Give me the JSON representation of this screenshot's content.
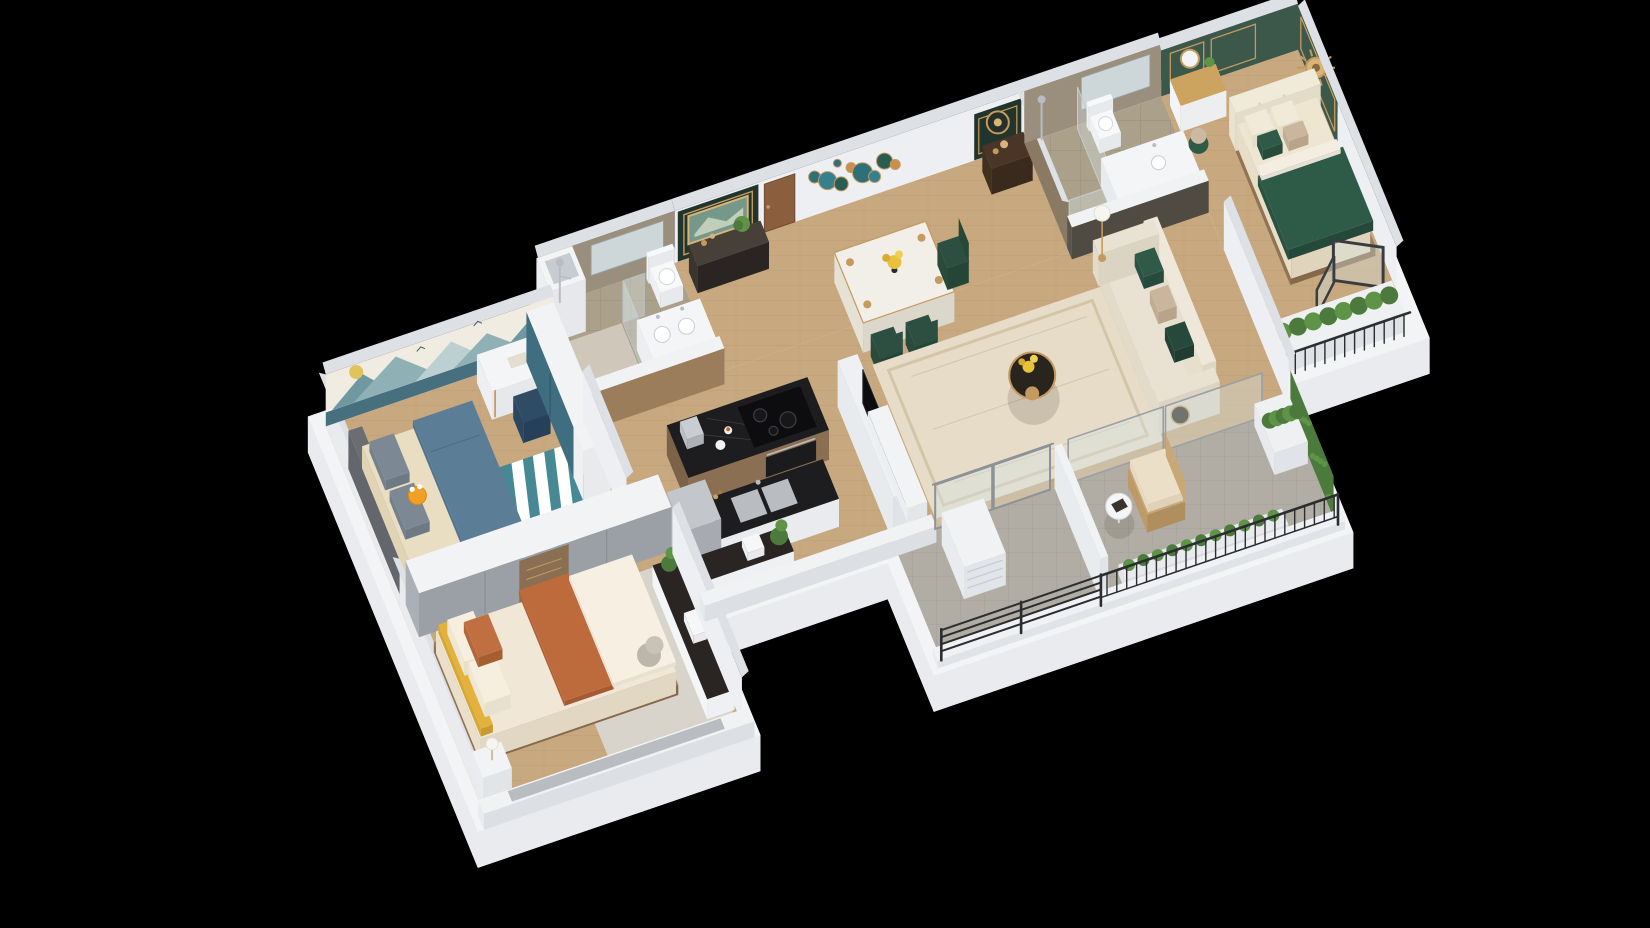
{
  "meta": {
    "title": "3D cutaway floor plan rendering of a furnished apartment",
    "background": "#000000"
  },
  "palette": {
    "plinthTop": "#f3f4f6",
    "plinthSide": "#e9ebee",
    "wallWhite": "#edeff2",
    "wallShade": "#e6e8ec",
    "wallCap": "#dde0e5",
    "stub": "#f1f2f4",
    "stubSide": "#dcdfe4",
    "wood": "#c7a87f",
    "woodLine": "#b2926c",
    "woodDark": "#8a6f52",
    "woodDoor": "#8a5f3e",
    "tile": "#aba089",
    "tileBalcony": "#b2ada4",
    "stone": "#9a8f7c",
    "stoneDark": "#8a7a64",
    "mirror": "#cdd6d8",
    "greenWall": "#3c584a",
    "greenDeep": "#22352c",
    "gold": "#c49a5f",
    "goldSoft": "#d8b478",
    "teal": "#3e6e80",
    "tealDeep": "#2e6f78",
    "tealWainscot": "#47707e",
    "muralBase": "#f1ece1",
    "muralM1": "#8fb0b5",
    "muralM2": "#bcd0d2",
    "muralM3": "#6f98a0",
    "sun": "#e0c35c",
    "sofaCream": "#e9e2d2",
    "pillowGreen": "#2f5a48",
    "pillowTan": "#c9b69c",
    "bedCream": "#efe6d2",
    "tuft": "#f0ead9",
    "greenBlanket": "#2e5a48",
    "blanketBlue": "#5b7e96",
    "rugTeal": "#3f8796",
    "rugLiving": "#e6dcc8",
    "rugLine": "#d3c5a9",
    "rugGray": "#d9d6d0",
    "orange": "#f0a026",
    "rust": "#bd6b3d",
    "yellow": "#e2b23c",
    "counterBlack": "#1d1d20",
    "steel": "#b9bdc1",
    "steelDark": "#9aa0a6",
    "greenPlant": "#4c7a3c",
    "greenPlant2": "#5e9448",
    "glass": "rgba(215,228,232,0.38)",
    "glassDark": "#55504a",
    "frame": "#3a3d40",
    "railing": "#2b2d2f",
    "chairNavy": "#2f4b66",
    "chairGreen": "#2c4f42",
    "grayDoor": "#9aa0a6",
    "headboardGray": "#6a6d72",
    "pillowGray": "#7c8894",
    "tableTop": "#f2efe8",
    "consoleDark": "#2a2523",
    "ratan": "#c9a878",
    "cushion": "#ecdfc8"
  },
  "rooms": [
    {
      "id": "kids-bedroom",
      "label": "Kids Bedroom"
    },
    {
      "id": "bathroom-main",
      "label": "Main Bathroom"
    },
    {
      "id": "foyer",
      "label": "Foyer / Art Wall"
    },
    {
      "id": "dining-area",
      "label": "Dining Area"
    },
    {
      "id": "entry-porch",
      "label": "Entry Console"
    },
    {
      "id": "bathroom-ensuite",
      "label": "Ensuite Bathroom"
    },
    {
      "id": "master-bedroom",
      "label": "Master Bedroom"
    },
    {
      "id": "kitchen",
      "label": "Kitchen"
    },
    {
      "id": "living-room",
      "label": "Living Room"
    },
    {
      "id": "second-bedroom",
      "label": "Second Bedroom"
    },
    {
      "id": "balcony",
      "label": "Balcony"
    }
  ]
}
